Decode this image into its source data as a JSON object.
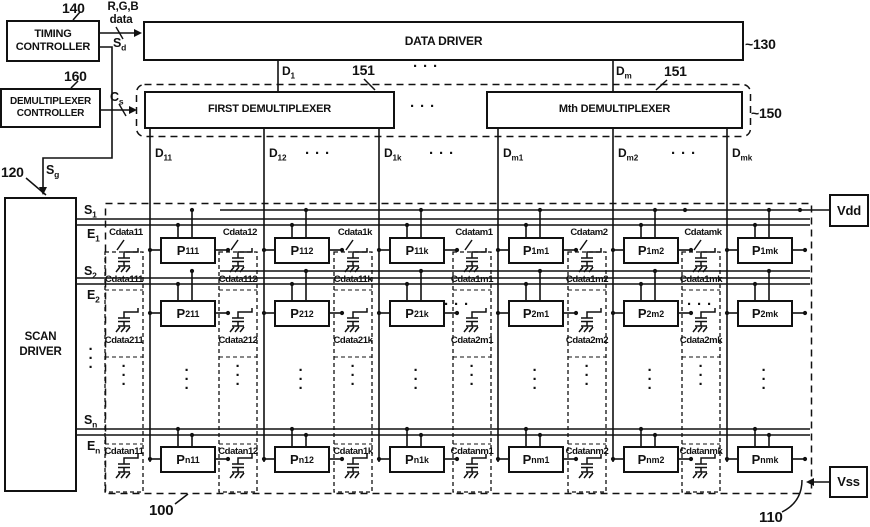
{
  "boxes": {
    "timing_l1": "TIMING",
    "timing_l2": "CONTROLLER",
    "demux_ctl_l1": "DEMULTIPLEXER",
    "demux_ctl_l2": "CONTROLLER",
    "data_driver": "DATA DRIVER",
    "first_demux": "FIRST DEMULTIPLEXER",
    "mth_demux": "Mth DEMULTIPLEXER",
    "scan_l1": "SCAN",
    "scan_l2": "DRIVER",
    "vdd": "Vdd",
    "vss": "Vss"
  },
  "refs": {
    "timing": "140",
    "demux_controller": "160",
    "data_driver": "~130",
    "demux_row": "~150",
    "first_demux_pin": "151",
    "mth_demux_pin": "151",
    "scan_driver": "120",
    "panel": "100",
    "pixel": "110"
  },
  "signals": {
    "rgb": "R,G,B",
    "rgb2": "data",
    "sd_base": "S",
    "sd_sub": "d",
    "cs_base": "C",
    "cs_sub": "s",
    "sg_base": "S",
    "sg_sub": "g",
    "d1_base": "D",
    "d1_sub": "1",
    "dm_base": "D",
    "dm_sub": "m"
  },
  "array": {
    "cap_prefix": "Cdata",
    "pixel_base": "P",
    "data_line_base": "D",
    "scan_base": "S",
    "emission_base": "E",
    "columns": [
      {
        "sub": "11"
      },
      {
        "sub": "12"
      },
      {
        "sub": "1k"
      },
      {
        "sub": "m1"
      },
      {
        "sub": "m2"
      },
      {
        "sub": "mk"
      }
    ],
    "rows": [
      {
        "sub": "1"
      },
      {
        "sub": "2"
      },
      {
        "sub": "n"
      }
    ]
  },
  "ellipsis": {
    "dot": "·"
  }
}
